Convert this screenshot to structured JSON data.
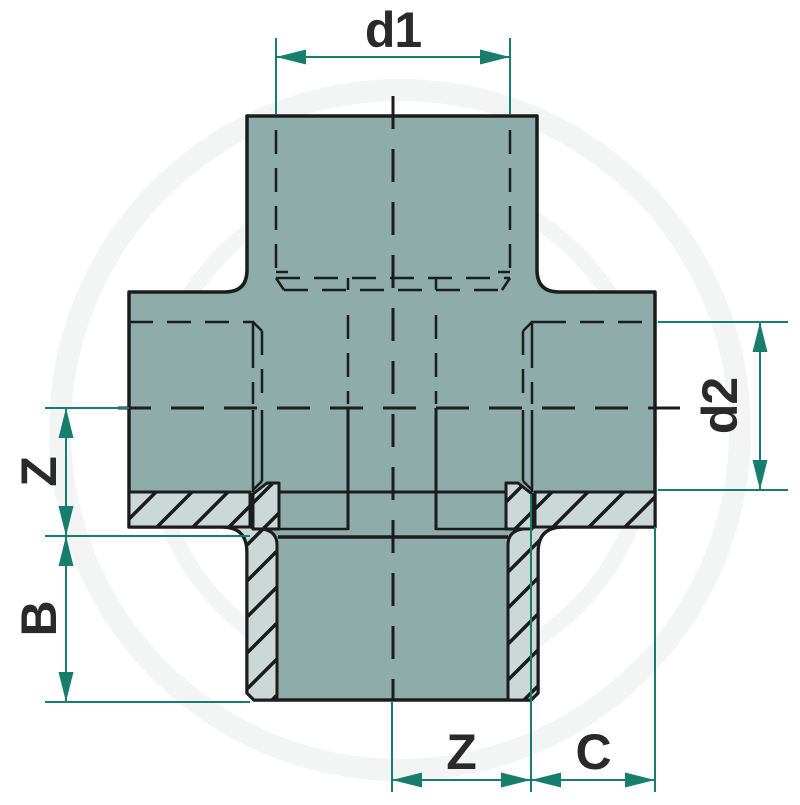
{
  "drawing": {
    "title": "pipe-union-cross-fitting-section-diagram",
    "dimensions": {
      "d1": {
        "label": "d1"
      },
      "d2": {
        "label": "d2"
      },
      "z_left": {
        "label": "Z"
      },
      "b_left": {
        "label": "B"
      },
      "z_bottom": {
        "label": "Z"
      },
      "c_bottom": {
        "label": "C"
      }
    },
    "colors": {
      "body_fill": "#8dacaa",
      "section_fill": "#cbd8d5",
      "outline": "#1c1c1c",
      "dimension_line": "#177e6e",
      "label_text": "#2a2a2a",
      "watermark": "#f3f4f4",
      "background": "#ffffff"
    }
  }
}
